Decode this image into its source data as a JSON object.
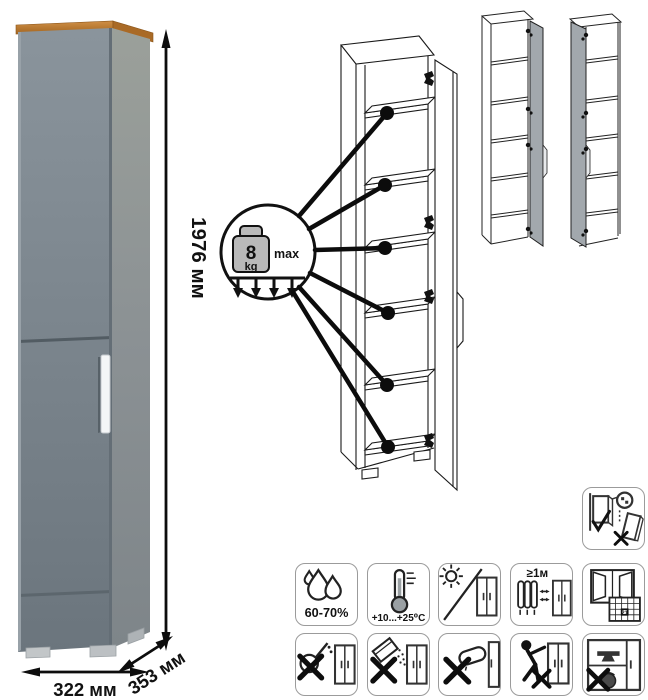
{
  "dimensions": {
    "height": "1976 мм",
    "width": "322 мм",
    "depth": "353 мм"
  },
  "load_badge": {
    "value": "8",
    "unit": "kg",
    "qualifier": "max",
    "shelf_callouts": 6
  },
  "colors": {
    "cabinet_front_top": "#87919a",
    "cabinet_front_bottom": "#6d777f",
    "cabinet_side_top": "#9aa09b",
    "cabinet_side_bottom": "#82898e",
    "wood_top": "#b5743a",
    "handle": "#f4f6f7",
    "drawing_line": "#1a1a1a",
    "drawing_door_fill": "#a2a8ad",
    "icon_border": "#9b9b9b"
  },
  "icons": [
    {
      "name": "anchor-to-wall-icon"
    },
    {
      "name": "humidity-icon",
      "label": "60-70%"
    },
    {
      "name": "temperature-icon",
      "label": "+10...+25⁰C"
    },
    {
      "name": "no-direct-sunlight-icon"
    },
    {
      "name": "heat-source-distance-icon",
      "label": "≥1м"
    },
    {
      "name": "ventilation-icon",
      "calendar_day": "21"
    },
    {
      "name": "no-aggressive-liquids-icon"
    },
    {
      "name": "no-abrasive-powders-icon"
    },
    {
      "name": "no-wet-cloth-icon"
    },
    {
      "name": "no-dragging-icon"
    },
    {
      "name": "no-overloading-icon"
    }
  ]
}
